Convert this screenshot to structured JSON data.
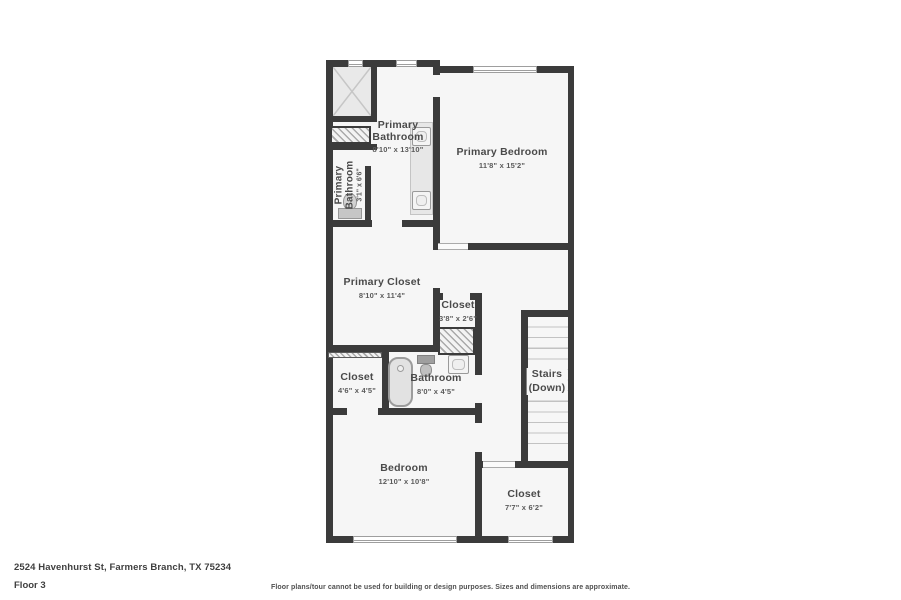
{
  "rooms": {
    "primary_bathroom": {
      "name": "Primary Bathroom",
      "dims": "8'10\" x 13'10\""
    },
    "primary_bathroom_wc": {
      "name": "Primary Bathroom",
      "dims": "3'1\" x 6'6\""
    },
    "primary_bedroom": {
      "name": "Primary Bedroom",
      "dims": "11'8\" x 15'2\""
    },
    "primary_closet": {
      "name": "Primary Closet",
      "dims": "8'10\" x 11'4\""
    },
    "closet_hall": {
      "name": "Closet",
      "dims": "3'8\" x 2'6\""
    },
    "closet_bedroom": {
      "name": "Closet",
      "dims": "4'6\" x 4'5\""
    },
    "bathroom": {
      "name": "Bathroom",
      "dims": "8'0\" x 4'5\""
    },
    "stairs": {
      "name": "Stairs",
      "sub": "(Down)"
    },
    "bedroom": {
      "name": "Bedroom",
      "dims": "12'10\" x 10'8\""
    },
    "closet_back": {
      "name": "Closet",
      "dims": "7'7\" x 6'2\""
    }
  },
  "footer": {
    "address": "2524 Havenhurst St, Farmers Branch, TX 75234",
    "floor": "Floor 3",
    "disclaimer": "Floor plans/tour cannot be used for building or design purposes. Sizes and dimensions are approximate."
  },
  "colors": {
    "wall": "#3b3b3b",
    "floor": "#f6f6f6",
    "fixture_gray": "#c6c6c6",
    "text": "#4a4a4a"
  }
}
